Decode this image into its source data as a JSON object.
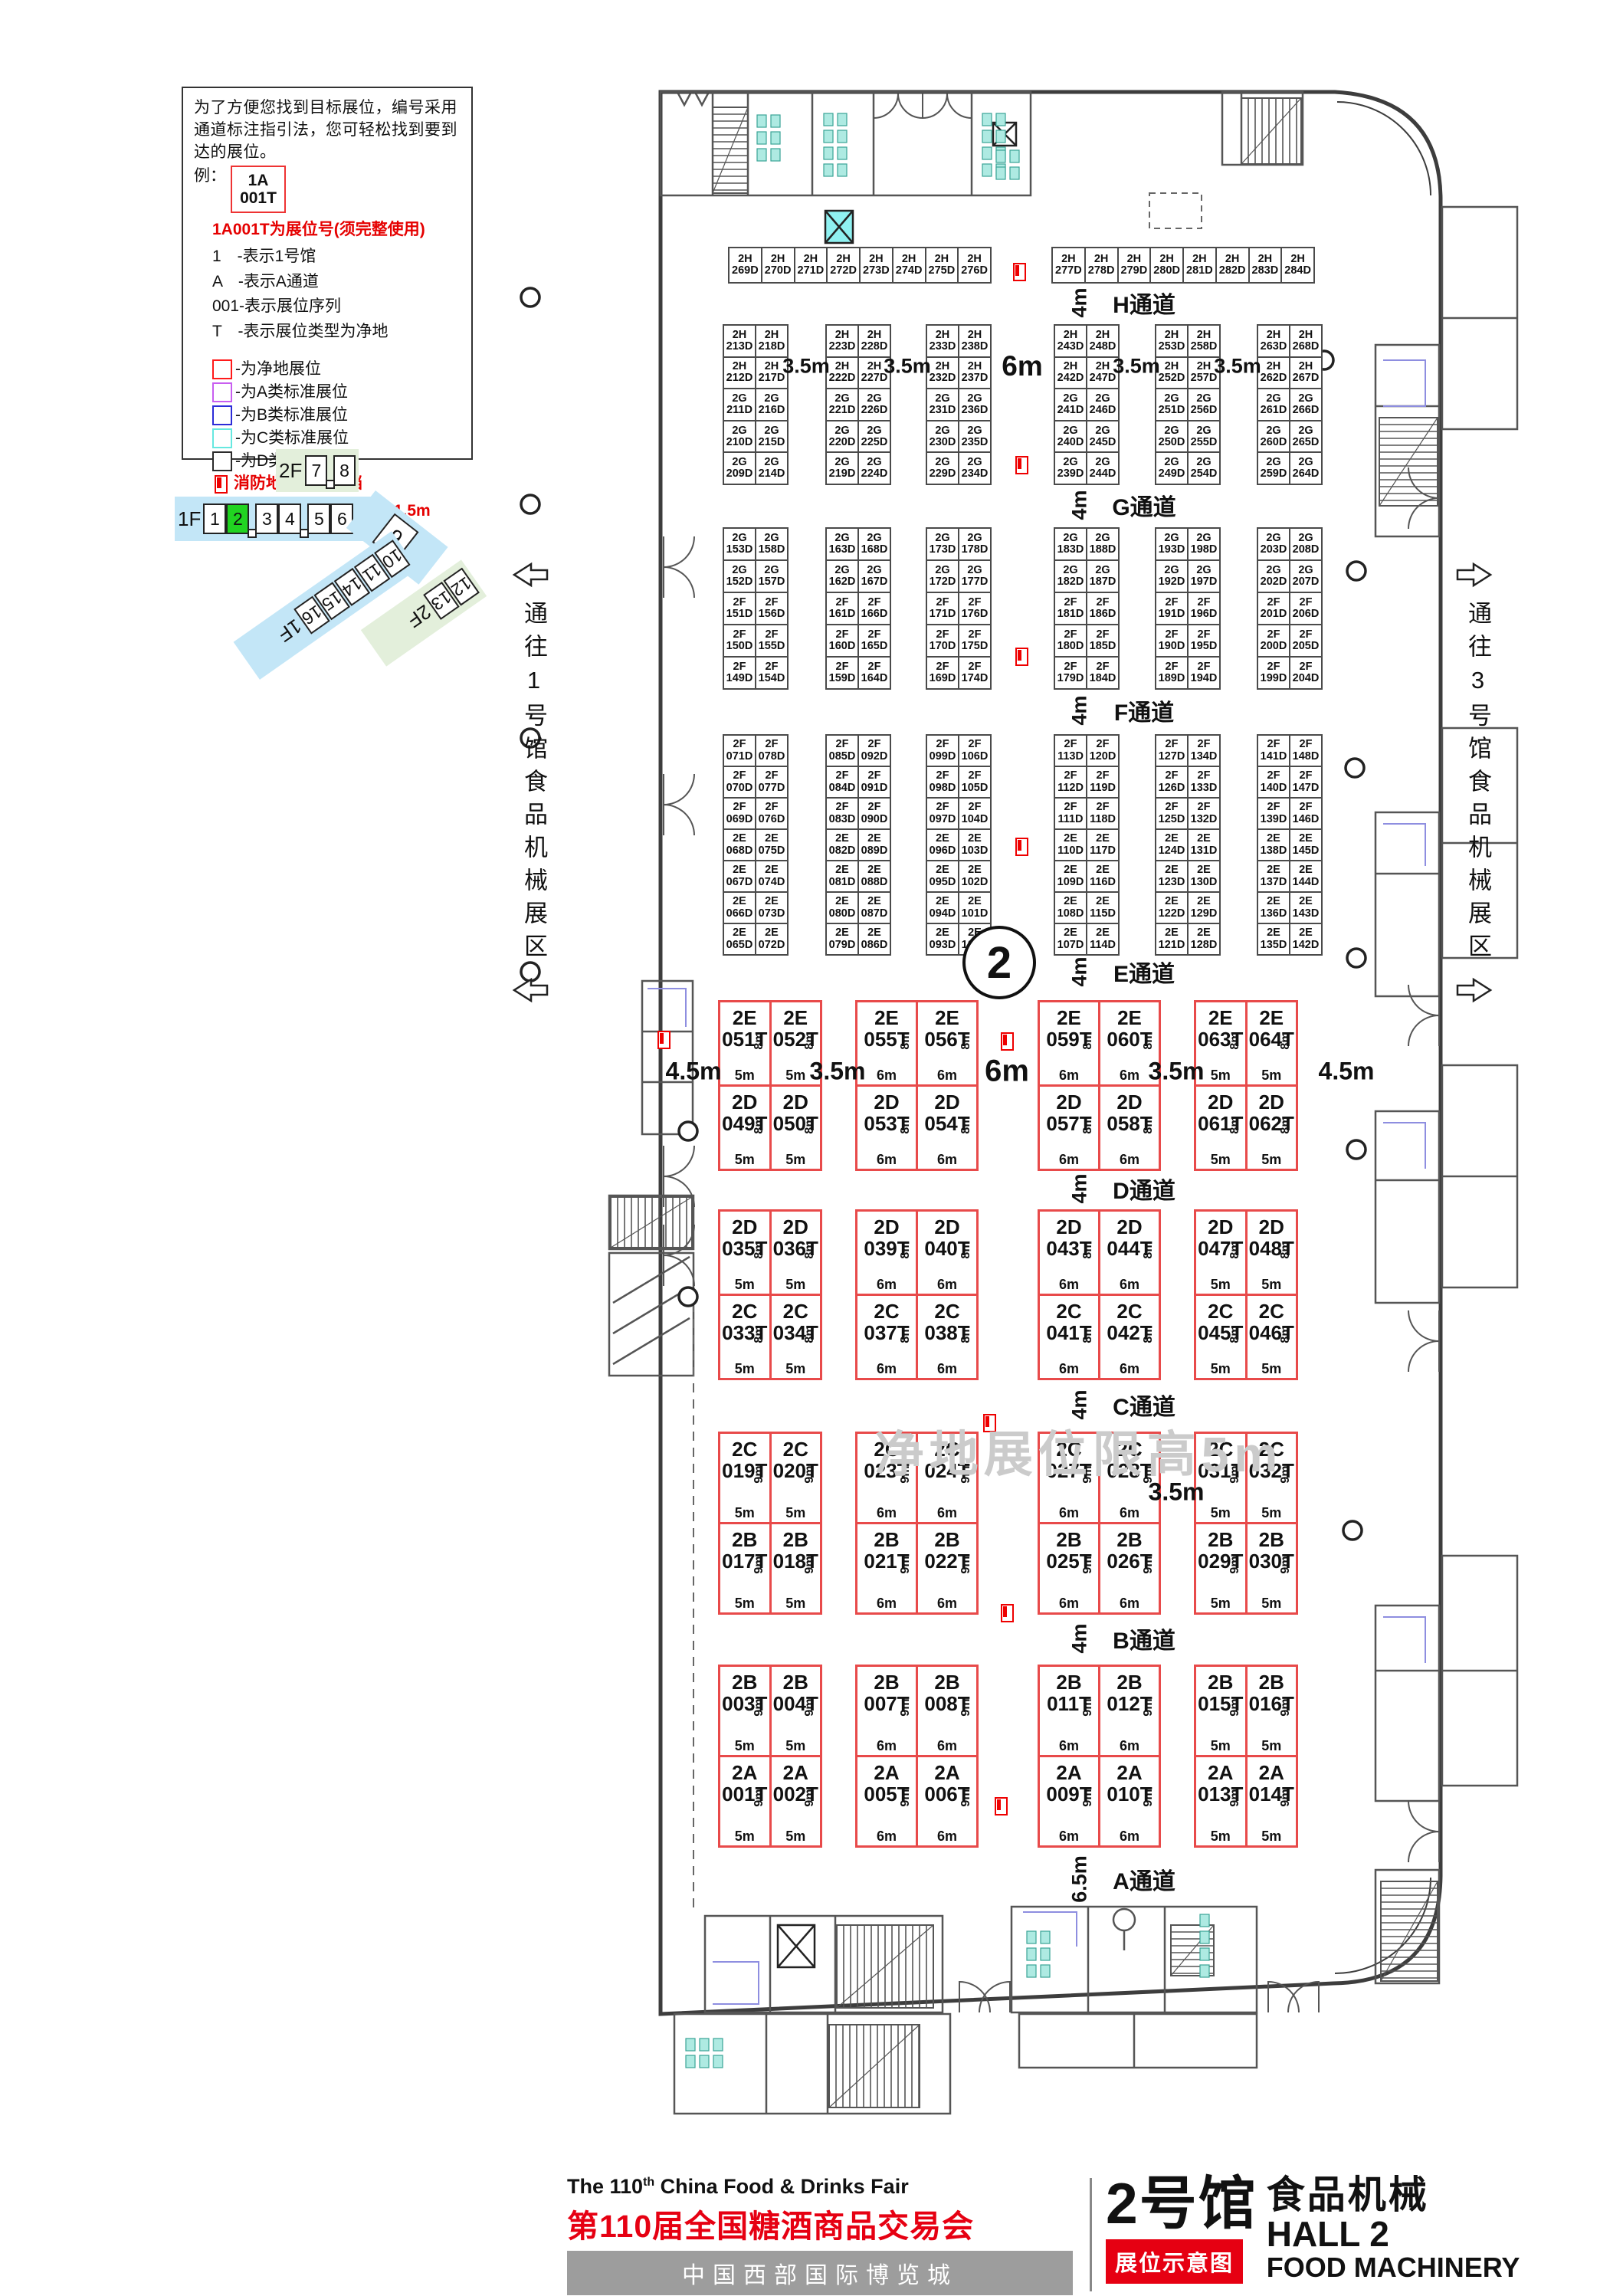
{
  "legend": {
    "intro": "为了方便您找到目标展位，编号采用通道标注指引法，您可轻松找到要到达的展位。",
    "example_prefix": "例：",
    "example_line1": "1A",
    "example_line2": "001T",
    "note_red": "1A001T为展位号(须完整使用)",
    "items": [
      "1　-表示1号馆",
      "A　-表示A通道",
      "001-表示展位序列",
      "T　-表示展位类型为净地"
    ],
    "swatches": [
      {
        "color": "#ff1a1a",
        "label": "-为净地展位"
      },
      {
        "color": "#c85ef0",
        "label": "-为A类标准展位"
      },
      {
        "color": "#2c2cd8",
        "label": "-为B类标准展位"
      },
      {
        "color": "#66e8e0",
        "label": "-为C类标准展位"
      },
      {
        "color": "#2b2b2b",
        "label": "-为D类标准展位"
      }
    ],
    "fire_note": "消防地井严禁遮挡",
    "pillar_note": "展位内立柱 直径均为1.5m"
  },
  "minimap": {
    "floor2": "2F",
    "floor1": "1F",
    "halls_2f": [
      "7",
      "8"
    ],
    "halls_1f": [
      "1",
      "2",
      "3",
      "4",
      "5",
      "6"
    ],
    "current": "2",
    "current_color": "#21d421",
    "hall9": "9",
    "diag": [
      "10",
      "11",
      "14",
      "15",
      "16"
    ],
    "diag_floor": "1F",
    "green": [
      "12",
      "13"
    ],
    "green_floor": "2F",
    "blue": "#c3e6f7",
    "lightgreen": "#e3efdb"
  },
  "corridors": {
    "left": "通往1号馆食品机械展区",
    "right": "通往3号馆食品机械展区"
  },
  "plan": {
    "hall_number": "2",
    "watermark": "净地展位限高5m",
    "aisles": [
      {
        "name": "H通道",
        "dim": "4m"
      },
      {
        "name": "G通道",
        "dim": "4m"
      },
      {
        "name": "F通道",
        "dim": "4m"
      },
      {
        "name": "E通道",
        "dim": "4m"
      },
      {
        "name": "D通道",
        "dim": "4m"
      },
      {
        "name": "C通道",
        "dim": "4m"
      },
      {
        "name": "B通道",
        "dim": "4m"
      },
      {
        "name": "A通道",
        "dim": "6.5m"
      }
    ],
    "std_gap_dims": [
      "3.5m",
      "3.5m",
      "6m",
      "3.5m",
      "3.5m"
    ],
    "red_dims_band1": [
      "4.5m",
      "3.5m",
      "6m",
      "3.5m",
      "4.5m"
    ],
    "red_dims_band3": [
      "3.5m"
    ],
    "top_row": {
      "left": [
        "2H 269D",
        "2H 270D",
        "2H 271D",
        "2H 272D",
        "2H 273D",
        "2H 274D",
        "2H 275D",
        "2H 276D"
      ],
      "right": [
        "2H 277D",
        "2H 278D",
        "2H 279D",
        "2H 280D",
        "2H 281D",
        "2H 282D",
        "2H 283D",
        "2H 284D"
      ]
    },
    "std_bands": [
      {
        "blocks": [
          [
            [
              "2H 213D",
              "2H 218D"
            ],
            [
              "2H 212D",
              "2H 217D"
            ],
            [
              "2G 211D",
              "2G 216D"
            ],
            [
              "2G 210D",
              "2G 215D"
            ],
            [
              "2G 209D",
              "2G 214D"
            ]
          ],
          [
            [
              "2H 223D",
              "2H 228D"
            ],
            [
              "2H 222D",
              "2H 227D"
            ],
            [
              "2G 221D",
              "2G 226D"
            ],
            [
              "2G 220D",
              "2G 225D"
            ],
            [
              "2G 219D",
              "2G 224D"
            ]
          ],
          [
            [
              "2H 233D",
              "2H 238D"
            ],
            [
              "2H 232D",
              "2H 237D"
            ],
            [
              "2G 231D",
              "2G 236D"
            ],
            [
              "2G 230D",
              "2G 235D"
            ],
            [
              "2G 229D",
              "2G 234D"
            ]
          ],
          [
            [
              "2H 243D",
              "2H 248D"
            ],
            [
              "2H 242D",
              "2H 247D"
            ],
            [
              "2G 241D",
              "2G 246D"
            ],
            [
              "2G 240D",
              "2G 245D"
            ],
            [
              "2G 239D",
              "2G 244D"
            ]
          ],
          [
            [
              "2H 253D",
              "2H 258D"
            ],
            [
              "2H 252D",
              "2H 257D"
            ],
            [
              "2G 251D",
              "2G 256D"
            ],
            [
              "2G 250D",
              "2G 255D"
            ],
            [
              "2G 249D",
              "2G 254D"
            ]
          ],
          [
            [
              "2H 263D",
              "2H 268D"
            ],
            [
              "2H 262D",
              "2H 267D"
            ],
            [
              "2G 261D",
              "2G 266D"
            ],
            [
              "2G 260D",
              "2G 265D"
            ],
            [
              "2G 259D",
              "2G 264D"
            ]
          ]
        ]
      },
      {
        "blocks": [
          [
            [
              "2G 153D",
              "2G 158D"
            ],
            [
              "2G 152D",
              "2G 157D"
            ],
            [
              "2F 151D",
              "2F 156D"
            ],
            [
              "2F 150D",
              "2F 155D"
            ],
            [
              "2F 149D",
              "2F 154D"
            ]
          ],
          [
            [
              "2G 163D",
              "2G 168D"
            ],
            [
              "2G 162D",
              "2G 167D"
            ],
            [
              "2F 161D",
              "2F 166D"
            ],
            [
              "2F 160D",
              "2F 165D"
            ],
            [
              "2F 159D",
              "2F 164D"
            ]
          ],
          [
            [
              "2G 173D",
              "2G 178D"
            ],
            [
              "2G 172D",
              "2G 177D"
            ],
            [
              "2F 171D",
              "2F 176D"
            ],
            [
              "2F 170D",
              "2F 175D"
            ],
            [
              "2F 169D",
              "2F 174D"
            ]
          ],
          [
            [
              "2G 183D",
              "2G 188D"
            ],
            [
              "2G 182D",
              "2G 187D"
            ],
            [
              "2F 181D",
              "2F 186D"
            ],
            [
              "2F 180D",
              "2F 185D"
            ],
            [
              "2F 179D",
              "2F 184D"
            ]
          ],
          [
            [
              "2G 193D",
              "2G 198D"
            ],
            [
              "2G 192D",
              "2G 197D"
            ],
            [
              "2F 191D",
              "2F 196D"
            ],
            [
              "2F 190D",
              "2F 195D"
            ],
            [
              "2F 189D",
              "2F 194D"
            ]
          ],
          [
            [
              "2G 203D",
              "2G 208D"
            ],
            [
              "2G 202D",
              "2G 207D"
            ],
            [
              "2F 201D",
              "2F 206D"
            ],
            [
              "2F 200D",
              "2F 205D"
            ],
            [
              "2F 199D",
              "2F 204D"
            ]
          ]
        ]
      },
      {
        "blocks": [
          [
            [
              "2F 071D",
              "2F 078D"
            ],
            [
              "2F 070D",
              "2F 077D"
            ],
            [
              "2F 069D",
              "2F 076D"
            ],
            [
              "2E 068D",
              "2E 075D"
            ],
            [
              "2E 067D",
              "2E 074D"
            ],
            [
              "2E 066D",
              "2E 073D"
            ],
            [
              "2E 065D",
              "2E 072D"
            ]
          ],
          [
            [
              "2F 085D",
              "2F 092D"
            ],
            [
              "2F 084D",
              "2F 091D"
            ],
            [
              "2F 083D",
              "2F 090D"
            ],
            [
              "2E 082D",
              "2E 089D"
            ],
            [
              "2E 081D",
              "2E 088D"
            ],
            [
              "2E 080D",
              "2E 087D"
            ],
            [
              "2E 079D",
              "2E 086D"
            ]
          ],
          [
            [
              "2F 099D",
              "2F 106D"
            ],
            [
              "2F 098D",
              "2F 105D"
            ],
            [
              "2F 097D",
              "2F 104D"
            ],
            [
              "2E 096D",
              "2E 103D"
            ],
            [
              "2E 095D",
              "2E 102D"
            ],
            [
              "2E 094D",
              "2E 101D"
            ],
            [
              "2E 093D",
              "2E 100D"
            ]
          ],
          [
            [
              "2F 113D",
              "2F 120D"
            ],
            [
              "2F 112D",
              "2F 119D"
            ],
            [
              "2F 111D",
              "2F 118D"
            ],
            [
              "2E 110D",
              "2E 117D"
            ],
            [
              "2E 109D",
              "2E 116D"
            ],
            [
              "2E 108D",
              "2E 115D"
            ],
            [
              "2E 107D",
              "2E 114D"
            ]
          ],
          [
            [
              "2F 127D",
              "2F 134D"
            ],
            [
              "2F 126D",
              "2F 133D"
            ],
            [
              "2F 125D",
              "2F 132D"
            ],
            [
              "2E 124D",
              "2E 131D"
            ],
            [
              "2E 123D",
              "2E 130D"
            ],
            [
              "2E 122D",
              "2E 129D"
            ],
            [
              "2E 121D",
              "2E 128D"
            ]
          ],
          [
            [
              "2F 141D",
              "2F 148D"
            ],
            [
              "2F 140D",
              "2F 147D"
            ],
            [
              "2F 139D",
              "2F 146D"
            ],
            [
              "2E 138D",
              "2E 145D"
            ],
            [
              "2E 137D",
              "2E 144D"
            ],
            [
              "2E 136D",
              "2E 143D"
            ],
            [
              "2E 135D",
              "2E 142D"
            ]
          ]
        ]
      }
    ],
    "red_bands": [
      {
        "side_dim": "8m",
        "blocks": [
          {
            "w": "5m",
            "top": [
              "2E 051T",
              "2E 052T"
            ],
            "bottom": [
              "2D 049T",
              "2D 050T"
            ]
          },
          {
            "w": "6m",
            "top": [
              "2E 055T",
              "2E 056T"
            ],
            "bottom": [
              "2D 053T",
              "2D 054T"
            ]
          },
          {
            "w": "6m",
            "top": [
              "2E 059T",
              "2E 060T"
            ],
            "bottom": [
              "2D 057T",
              "2D 058T"
            ]
          },
          {
            "w": "5m",
            "top": [
              "2E 063T",
              "2E 064T"
            ],
            "bottom": [
              "2D 061T",
              "2D 062T"
            ]
          }
        ]
      },
      {
        "side_dim": "8m",
        "blocks": [
          {
            "w": "5m",
            "top": [
              "2D 035T",
              "2D 036T"
            ],
            "bottom": [
              "2C 033T",
              "2C 034T"
            ]
          },
          {
            "w": "6m",
            "top": [
              "2D 039T",
              "2D 040T"
            ],
            "bottom": [
              "2C 037T",
              "2C 038T"
            ]
          },
          {
            "w": "6m",
            "top": [
              "2D 043T",
              "2D 044T"
            ],
            "bottom": [
              "2C 041T",
              "2C 042T"
            ]
          },
          {
            "w": "5m",
            "top": [
              "2D 047T",
              "2D 048T"
            ],
            "bottom": [
              "2C 045T",
              "2C 046T"
            ]
          }
        ]
      },
      {
        "side_dim": "9m",
        "blocks": [
          {
            "w": "5m",
            "top": [
              "2C 019T",
              "2C 020T"
            ],
            "bottom": [
              "2B 017T",
              "2B 018T"
            ]
          },
          {
            "w": "6m",
            "top": [
              "2C 023T",
              "2C 024T"
            ],
            "bottom": [
              "2B 021T",
              "2B 022T"
            ]
          },
          {
            "w": "6m",
            "top": [
              "2C 027T",
              "2C 028T"
            ],
            "bottom": [
              "2B 025T",
              "2B 026T"
            ]
          },
          {
            "w": "5m",
            "top": [
              "2C 031T",
              "2C 032T"
            ],
            "bottom": [
              "2B 029T",
              "2B 030T"
            ]
          }
        ]
      },
      {
        "side_dim": "9m",
        "blocks": [
          {
            "w": "5m",
            "top": [
              "2B 003T",
              "2B 004T"
            ],
            "bottom": [
              "2A 001T",
              "2A 002T"
            ]
          },
          {
            "w": "6m",
            "top": [
              "2B 007T",
              "2B 008T"
            ],
            "bottom": [
              "2A 005T",
              "2A 006T"
            ]
          },
          {
            "w": "6m",
            "top": [
              "2B 011T",
              "2B 012T"
            ],
            "bottom": [
              "2A 009T",
              "2A 010T"
            ]
          },
          {
            "w": "5m",
            "top": [
              "2B 015T",
              "2B 016T"
            ],
            "bottom": [
              "2A 013T",
              "2A 014T"
            ]
          }
        ]
      }
    ]
  },
  "footer": {
    "en_title_pre": "The 110",
    "en_title_sup": "th",
    "en_title_post": " China Food & Drinks Fair",
    "cn_title": "第110届全国糖酒商品交易会",
    "venue": "中国西部国际博览城",
    "hall_cn": "2号馆",
    "hall_type_cn": "食品机械",
    "hall_en": "HALL 2",
    "hall_type_en": "FOOD MACHINERY",
    "badge": "展位示意图"
  }
}
